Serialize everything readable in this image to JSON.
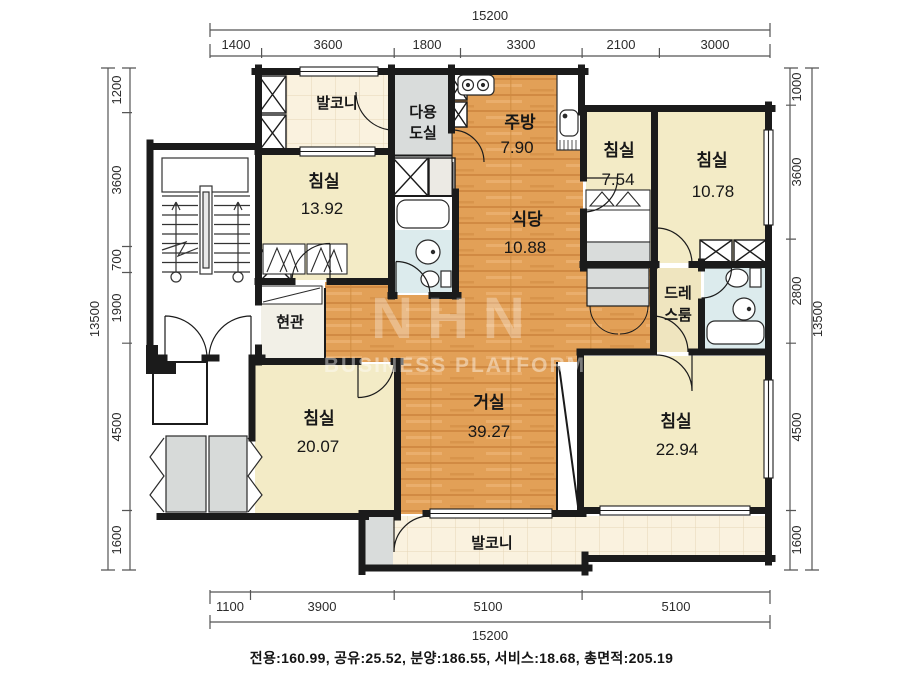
{
  "summary_line": "전용:160.99, 공유:25.52, 분양:186.55, 서비스:18.68, 총면적:205.19",
  "watermark": {
    "logo": "NHN",
    "subtitle": "BUSINESS PLATFORM"
  },
  "dimensions": {
    "top": {
      "total": "15200",
      "segments": [
        "1400",
        "3600",
        "1800",
        "3300",
        "2100",
        "3000"
      ]
    },
    "bottom": {
      "total": "15200",
      "segments": [
        "1100",
        "3900",
        "5100",
        "5100"
      ]
    },
    "left": {
      "total": "13500",
      "segments": [
        "1200",
        "3600",
        "700",
        "1900",
        "4500",
        "1600"
      ]
    },
    "right": {
      "total": "13500",
      "segments": [
        "1000",
        "3600",
        "2800",
        "4500",
        "1600"
      ]
    }
  },
  "rooms": {
    "balcony_top": {
      "name": "발코니"
    },
    "utility": {
      "line1": "다용",
      "line2": "도실"
    },
    "kitchen": {
      "name": "주방",
      "area": "7.90"
    },
    "dining": {
      "name": "식당",
      "area": "10.88"
    },
    "bedroom1": {
      "name": "침실",
      "area": "13.92"
    },
    "bedroom2": {
      "name": "침실",
      "area": "7.54"
    },
    "bedroom3": {
      "name": "침실",
      "area": "10.78"
    },
    "dressroom": {
      "line1": "드레",
      "line2": "스룸"
    },
    "entrance": {
      "name": "현관"
    },
    "living": {
      "name": "거실",
      "area": "39.27"
    },
    "bedroom4": {
      "name": "침실",
      "area": "20.07"
    },
    "bedroom5": {
      "name": "침실",
      "area": "22.94"
    },
    "balcony_bottom": {
      "name": "발코니"
    }
  },
  "colors": {
    "wall": "#1b1b1b",
    "wood_floor": "#e2a057",
    "bedroom_floor": "#f3ebc6",
    "balcony_floor": "#faf2df",
    "bathroom_floor": "#dcebed",
    "utility_floor": "#d9dcdb",
    "dress_floor": "#efe5bf"
  }
}
